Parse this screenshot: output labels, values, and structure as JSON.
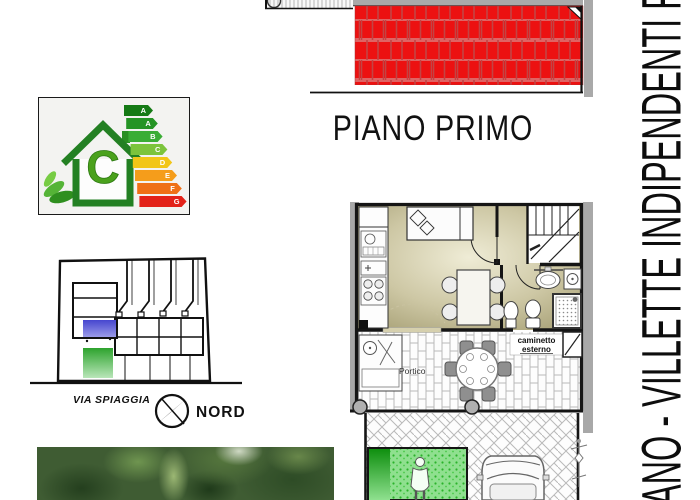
{
  "page": {
    "vertical_title": "ANO - VILLETTE INDIPENDENTI F",
    "floor_label": "PIANO PRIMO"
  },
  "energy_label": {
    "class_letter": "C",
    "bars": [
      {
        "letter": "A",
        "color": "#157a15"
      },
      {
        "letter": "A",
        "color": "#259425"
      },
      {
        "letter": "B",
        "color": "#3aad35"
      },
      {
        "letter": "C",
        "color": "#7cc43c"
      },
      {
        "letter": "D",
        "color": "#f2c618"
      },
      {
        "letter": "E",
        "color": "#f59d1b"
      },
      {
        "letter": "F",
        "color": "#ef7016"
      },
      {
        "letter": "G",
        "color": "#e32219"
      }
    ],
    "house_color": "#2a8f23"
  },
  "site_plan": {
    "street_label": "VIA SPIAGGIA",
    "compass_label": "NORD",
    "highlight_upper_color": "#4646cf",
    "highlight_lower_color": "#2da32d"
  },
  "floor_plan": {
    "portico_label": "Portico",
    "outdoor_fireplace_label": {
      "line1": "caminetto",
      "line2": "esterno"
    },
    "roof_color": "#ec1111",
    "interior_tint": "#b3ac83",
    "garden_color": "#5cd45c"
  }
}
